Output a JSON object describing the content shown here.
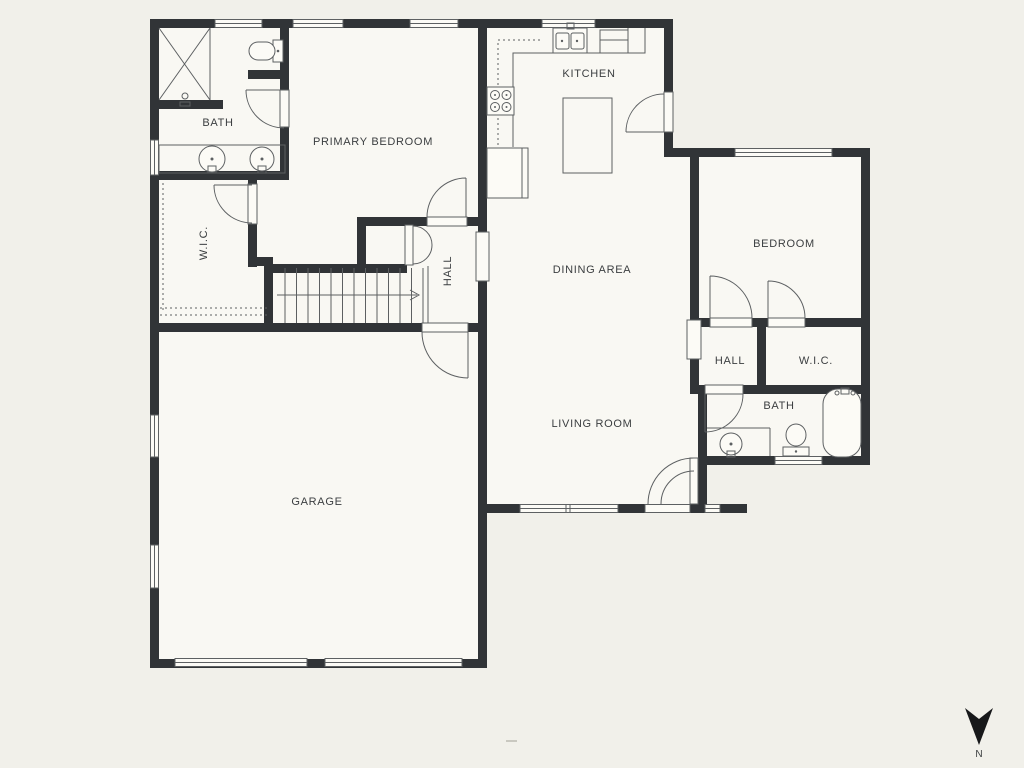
{
  "colors": {
    "background": "#f1f0ea",
    "floor": "#f9f8f3",
    "wall": "#313437",
    "line": "#5d6062",
    "text": "#3b3e40"
  },
  "rooms": {
    "bath_left": {
      "label": "BATH"
    },
    "primary_bedroom": {
      "label": "PRIMARY BEDROOM"
    },
    "kitchen": {
      "label": "KITCHEN"
    },
    "wic_left": {
      "label": "W.I.C."
    },
    "hall_left": {
      "label": "HALL"
    },
    "dining_area": {
      "label": "DINING AREA"
    },
    "living_room": {
      "label": "LIVING ROOM"
    },
    "garage": {
      "label": "GARAGE"
    },
    "bedroom": {
      "label": "BEDROOM"
    },
    "hall_right": {
      "label": "HALL"
    },
    "wic_right": {
      "label": "W.I.C."
    },
    "bath_right": {
      "label": "BATH"
    }
  },
  "compass": {
    "label": "N"
  },
  "icons": {
    "shower": "x-box",
    "toilet": "bowl-and-tank",
    "sink": "circle-basin",
    "bathtub": "rounded-tub",
    "stove": "four-burners",
    "kitchen_sink": "double-basin",
    "stairs": "treads-with-arrow",
    "north_arrow": "down-dart"
  }
}
